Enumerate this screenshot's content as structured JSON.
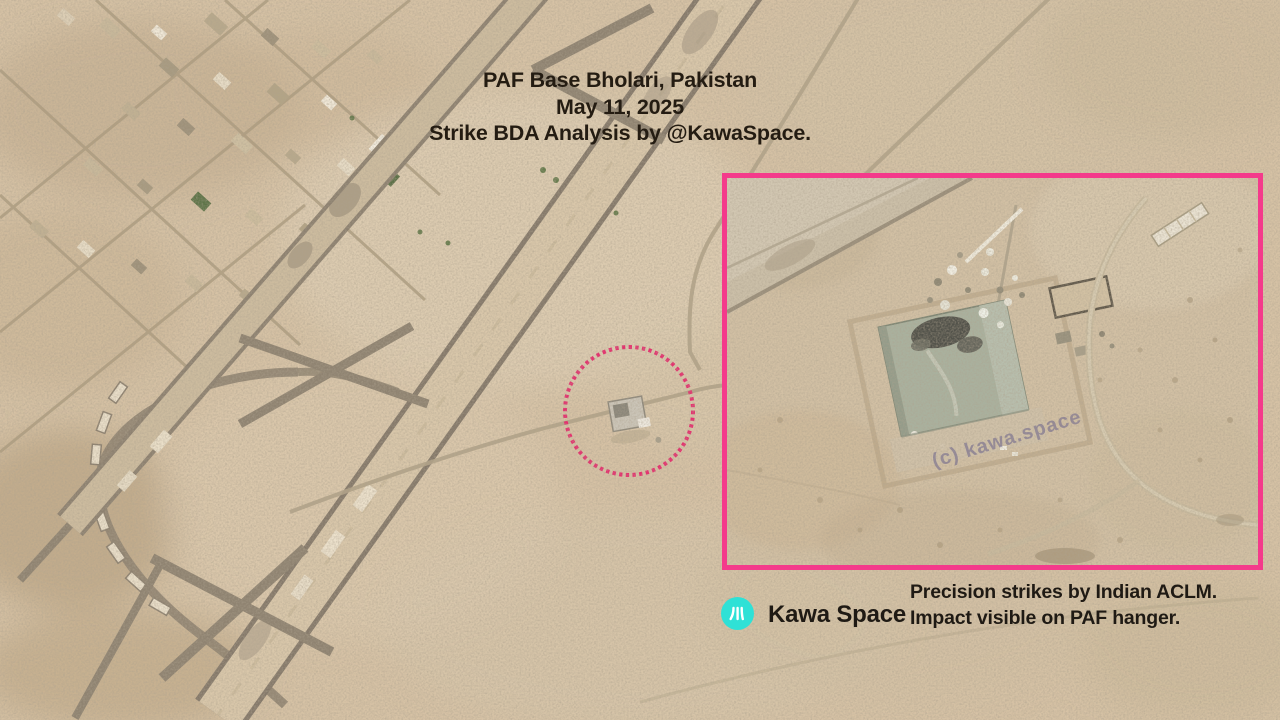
{
  "title": {
    "location": "PAF Base Bholari, Pakistan",
    "date": "May 11, 2025",
    "credit": "Strike BDA Analysis by @KawaSpace."
  },
  "annotations": {
    "target_circle_color": "#e62e6e",
    "inset_border_color": "#f43a8b",
    "watermark": "(c) kawa.space"
  },
  "footer": {
    "logo_icon": "river-strokes-icon",
    "logo_color": "#2fe1d6",
    "brand": "Kawa Space",
    "note_line1": "Precision strikes by Indian ACLM.",
    "note_line2": "Impact visible on PAF hanger."
  },
  "palette": {
    "desert_base": "#d6c2a5",
    "runway_edge": "#85796a",
    "runway_surface": "#d9c7aa",
    "hangar_roof": "#a9b19e"
  }
}
